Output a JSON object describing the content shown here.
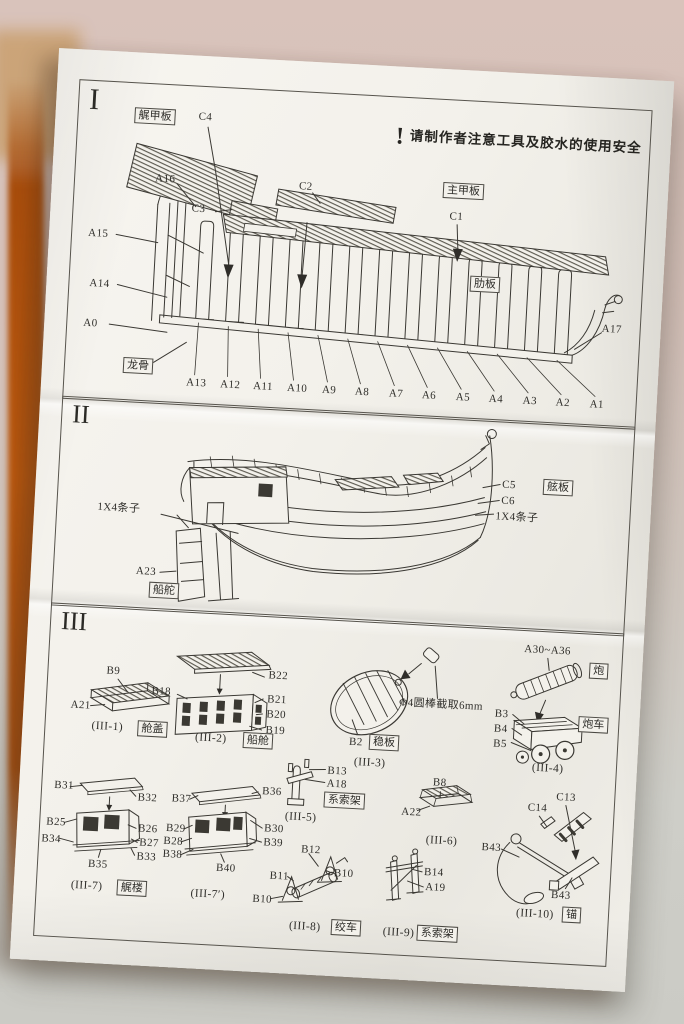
{
  "palette": {
    "paper": "#f3f1eb",
    "ink": "#3a3833",
    "desk_edge": "#b5540e",
    "background_top": "#d9c3bb",
    "background_bottom": "#cbcbc5"
  },
  "section1": {
    "numeral": "I",
    "warning_mark": "!",
    "warning_text": "请制作者注意工具及胶水的使用安全",
    "boxed_stern_deck": "艉甲板",
    "boxed_main_deck": "主甲板",
    "boxed_rib_plate": "肋板",
    "boxed_keel": "龙骨",
    "c4": "C4",
    "a16": "A16",
    "c3": "C3",
    "c2": "C2",
    "c1": "C1",
    "a15": "A15",
    "a14": "A14",
    "a0": "A0",
    "a17": "A17",
    "rib_row": [
      "A13",
      "A12",
      "A11",
      "A10",
      "A9",
      "A8",
      "A7",
      "A6",
      "A5",
      "A4",
      "A3",
      "A2",
      "A1"
    ]
  },
  "section2": {
    "numeral": "II",
    "c5": "C5",
    "c6": "C6",
    "boxed_side_plank": "舷板",
    "strips_right": "1X4条子",
    "strips_left": "1X4条子",
    "a23": "A23",
    "boxed_rudder": "船舵"
  },
  "section3": {
    "numeral": "III",
    "g1": {
      "caption": "(III-1)",
      "boxed": "舱盖",
      "b9": "B9",
      "a21": "A21"
    },
    "g2": {
      "caption": "(III-2)",
      "boxed": "船舱",
      "b22": "B22",
      "b18": "B18",
      "b21": "B21",
      "b20": "B20",
      "b19": "B19"
    },
    "g3": {
      "caption": "(III-3)",
      "boxed": "稳板",
      "b2": "B2",
      "note": "Φ4圆棒截取6mm"
    },
    "g4": {
      "caption": "(III-4)",
      "boxed_cannon": "炮",
      "boxed_carriage": "炮车",
      "range": "A30~A36",
      "b3": "B3",
      "b4": "B4",
      "b5": "B5"
    },
    "g5": {
      "caption": "(III-5)",
      "boxed": "系索架",
      "b13": "B13",
      "a18": "A18"
    },
    "g6": {
      "caption": "(III-6)",
      "b8": "B8",
      "a22": "A22"
    },
    "g7": {
      "caption": "(III-7)",
      "boxed": "艉楼",
      "b31": "B31",
      "b32": "B32",
      "b25": "B25",
      "b26": "B26",
      "b34": "B34",
      "b27": "B27",
      "b33": "B33",
      "b35": "B35"
    },
    "g7p": {
      "caption": "(III-7′)",
      "b37": "B37",
      "b36": "B36",
      "b29": "B29",
      "b30": "B30",
      "b28": "B28",
      "b39": "B39",
      "b38": "B38",
      "b40": "B40"
    },
    "g8": {
      "caption": "(III-8)",
      "boxed": "绞车",
      "b12": "B12",
      "b11": "B11",
      "b10_right": "B10",
      "b10_left": "B10"
    },
    "g9": {
      "caption": "(III-9)",
      "boxed": "系索架",
      "b14": "B14",
      "a19": "A19"
    },
    "g10": {
      "caption": "(III-10)",
      "boxed": "锚",
      "c14": "C14",
      "c13": "C13",
      "b43_mid": "B43",
      "b43_bottom": "B43"
    }
  }
}
